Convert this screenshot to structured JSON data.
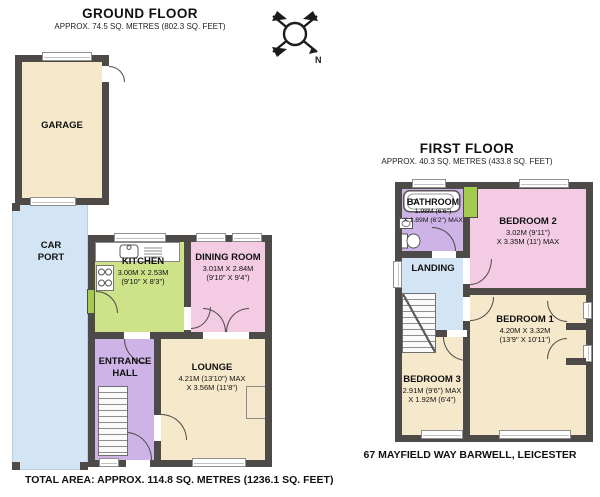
{
  "colors": {
    "wall": "#4e4a47",
    "cream": "#f6e8cb",
    "green": "#cde289",
    "pink": "#f3cce4",
    "purple": "#cdb3e6",
    "blue": "#d3e5f4",
    "door_green": "#a3cb4e"
  },
  "compass": {
    "north_label": "N"
  },
  "ground_floor": {
    "title": "GROUND FLOOR",
    "subtitle": "APPROX. 74.5 SQ. METRES (802.3 SQ. FEET)",
    "rooms": {
      "garage": {
        "name": "GARAGE"
      },
      "car_port": {
        "name": "CAR PORT"
      },
      "kitchen": {
        "name": "KITCHEN",
        "dim1": "3.00M X 2.53M",
        "dim2": "(9'10\" X 8'3\")"
      },
      "dining_room": {
        "name": "DINING ROOM",
        "dim1": "3.01M X 2.84M",
        "dim2": "(9'10\" X 9'4\")"
      },
      "entrance_hall": {
        "name": "ENTRANCE HALL"
      },
      "lounge": {
        "name": "LOUNGE",
        "dim1": "4.21M (13'10\") MAX",
        "dim2": "X 3.56M (11'8\")"
      }
    }
  },
  "first_floor": {
    "title": "FIRST FLOOR",
    "subtitle": "APPROX. 40.3 SQ. METRES (433.8 SQ. FEET)",
    "rooms": {
      "bathroom": {
        "name": "BATHROOM",
        "dim1": "1.98M (6'6\")",
        "dim2": "X 1.89M (6'2\") MAX"
      },
      "bedroom_2": {
        "name": "BEDROOM 2",
        "dim1": "3.02M (9'11\")",
        "dim2": "X 3.35M (11') MAX"
      },
      "landing": {
        "name": "LANDING"
      },
      "bedroom_1": {
        "name": "BEDROOM 1",
        "dim1": "4.20M X 3.32M",
        "dim2": "(13'9\" X 10'11\")"
      },
      "bedroom_3": {
        "name": "BEDROOM 3",
        "dim1": "2.91M (9'6\") MAX",
        "dim2": "X 1.92M (6'4\")"
      }
    }
  },
  "captions": {
    "total_area": "TOTAL AREA: APPROX. 114.8 SQ. METRES (1236.1 SQ. FEET)",
    "address": "67 MAYFIELD WAY BARWELL, LEICESTER"
  }
}
